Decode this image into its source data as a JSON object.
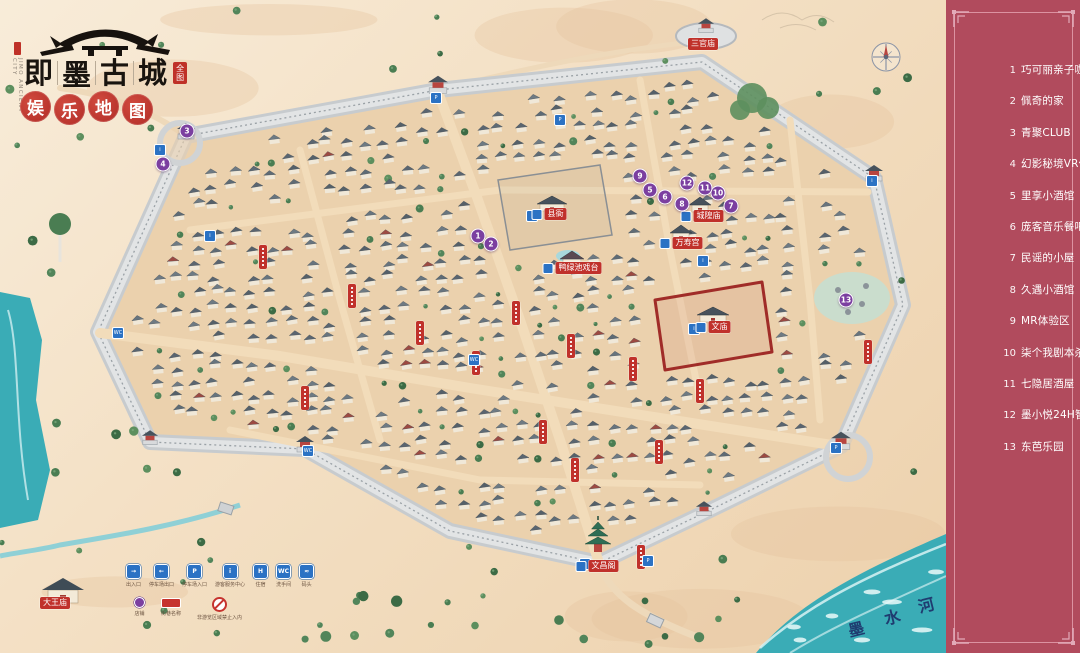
{
  "header": {
    "english_name": "JIMO ANCIENT CITY",
    "city_name_chars": [
      "即",
      "墨",
      "古",
      "城"
    ],
    "title_seal_chars": [
      "全",
      "图"
    ],
    "subtitle_chars": [
      "娱",
      "乐",
      "地",
      "图"
    ]
  },
  "sidebar": {
    "bg_color": "#b14b5d",
    "items": [
      {
        "num": "1",
        "label": "巧可丽亲子咖啡乐园"
      },
      {
        "num": "2",
        "label": "佩奇的家"
      },
      {
        "num": "3",
        "label": "青聚CLUB"
      },
      {
        "num": "4",
        "label": "幻影秘境VR体验馆"
      },
      {
        "num": "5",
        "label": "里享小酒馆"
      },
      {
        "num": "6",
        "label": "庞客音乐餐吧"
      },
      {
        "num": "7",
        "label": "民谣的小屋"
      },
      {
        "num": "8",
        "label": "久遇小酒馆"
      },
      {
        "num": "9",
        "label": "MR体验区"
      },
      {
        "num": "10",
        "label": "柒个我剧本杀"
      },
      {
        "num": "11",
        "label": "七隐居酒屋"
      },
      {
        "num": "12",
        "label": "墨小悦24H智能茶室"
      },
      {
        "num": "13",
        "label": "东芭乐园"
      }
    ]
  },
  "legend": {
    "row1": [
      {
        "icon": "entrance-icon",
        "glyph": "→",
        "label": "出入口"
      },
      {
        "icon": "parking-exit-icon",
        "glyph": "←",
        "label": "停车场出口"
      },
      {
        "icon": "parking-icon",
        "glyph": "P",
        "label": "停车场入口"
      },
      {
        "icon": "info-icon",
        "glyph": "i",
        "label": "游客服务中心"
      },
      {
        "icon": "hotel-icon",
        "glyph": "H",
        "label": "住宿"
      },
      {
        "icon": "restroom-icon",
        "glyph": "WC",
        "label": "洗手间"
      },
      {
        "icon": "dock-icon",
        "glyph": "≈",
        "label": "码头"
      }
    ],
    "row2": [
      {
        "icon": "shop-marker-icon",
        "label": "店铺"
      },
      {
        "icon": "street-banner-icon",
        "label": "街巷名称"
      },
      {
        "icon": "no-entry-icon",
        "label": "非游览区域禁止入内"
      }
    ]
  },
  "map": {
    "river_name": "墨水河",
    "river_label_chars": [
      {
        "ch": "墨",
        "x": 848,
        "y": 616
      },
      {
        "ch": "水",
        "x": 884,
        "y": 604
      },
      {
        "ch": "河",
        "x": 918,
        "y": 592
      }
    ],
    "landmarks": [
      {
        "name": "三官庙",
        "x": 703,
        "y": 44,
        "icon": false
      },
      {
        "name": "县衙",
        "x": 549,
        "y": 214,
        "icon": true
      },
      {
        "name": "城隍庙",
        "x": 702,
        "y": 216,
        "icon": true
      },
      {
        "name": "万寿宫",
        "x": 681,
        "y": 243,
        "icon": true
      },
      {
        "name": "鸭绿池戏台",
        "x": 572,
        "y": 268,
        "icon": true
      },
      {
        "name": "文庙",
        "x": 713,
        "y": 327,
        "icon": true
      },
      {
        "name": "文昌阁",
        "x": 597,
        "y": 566,
        "icon": true
      },
      {
        "name": "大王庙",
        "x": 55,
        "y": 603,
        "icon": false
      }
    ],
    "markers": [
      {
        "num": "1",
        "x": 478,
        "y": 236
      },
      {
        "num": "2",
        "x": 491,
        "y": 244
      },
      {
        "num": "3",
        "x": 187,
        "y": 131
      },
      {
        "num": "4",
        "x": 163,
        "y": 164
      },
      {
        "num": "5",
        "x": 650,
        "y": 190
      },
      {
        "num": "6",
        "x": 665,
        "y": 197
      },
      {
        "num": "7",
        "x": 731,
        "y": 206
      },
      {
        "num": "8",
        "x": 682,
        "y": 204
      },
      {
        "num": "9",
        "x": 640,
        "y": 176
      },
      {
        "num": "10",
        "x": 718,
        "y": 193
      },
      {
        "num": "11",
        "x": 705,
        "y": 188
      },
      {
        "num": "12",
        "x": 687,
        "y": 183
      },
      {
        "num": "13",
        "x": 846,
        "y": 300
      }
    ],
    "street_banners": [
      [
        263,
        257
      ],
      [
        352,
        296
      ],
      [
        420,
        333
      ],
      [
        516,
        313
      ],
      [
        476,
        363
      ],
      [
        571,
        346
      ],
      [
        633,
        369
      ],
      [
        543,
        432
      ],
      [
        659,
        452
      ],
      [
        700,
        391
      ],
      [
        575,
        470
      ],
      [
        641,
        557
      ],
      [
        868,
        352
      ],
      [
        305,
        398
      ]
    ],
    "facility_icons": [
      [
        436,
        98,
        "P"
      ],
      [
        160,
        150,
        "i"
      ],
      [
        118,
        333,
        "WC"
      ],
      [
        532,
        216,
        "i"
      ],
      [
        694,
        329,
        "i"
      ],
      [
        585,
        564,
        "i"
      ],
      [
        836,
        448,
        "P"
      ],
      [
        308,
        451,
        "WC"
      ],
      [
        648,
        561,
        "P"
      ],
      [
        703,
        261,
        "i"
      ],
      [
        474,
        360,
        "WC"
      ],
      [
        872,
        181,
        "i"
      ],
      [
        560,
        120,
        "P"
      ],
      [
        210,
        236,
        "i"
      ]
    ]
  },
  "colors": {
    "accent_red": "#c0312b",
    "marker_purple": "#7b3fa0",
    "facility_blue": "#2b72c4",
    "river_teal": "#3aacb6",
    "wall_gray": "#dfe2e3",
    "sand": "#f3e0c6"
  }
}
